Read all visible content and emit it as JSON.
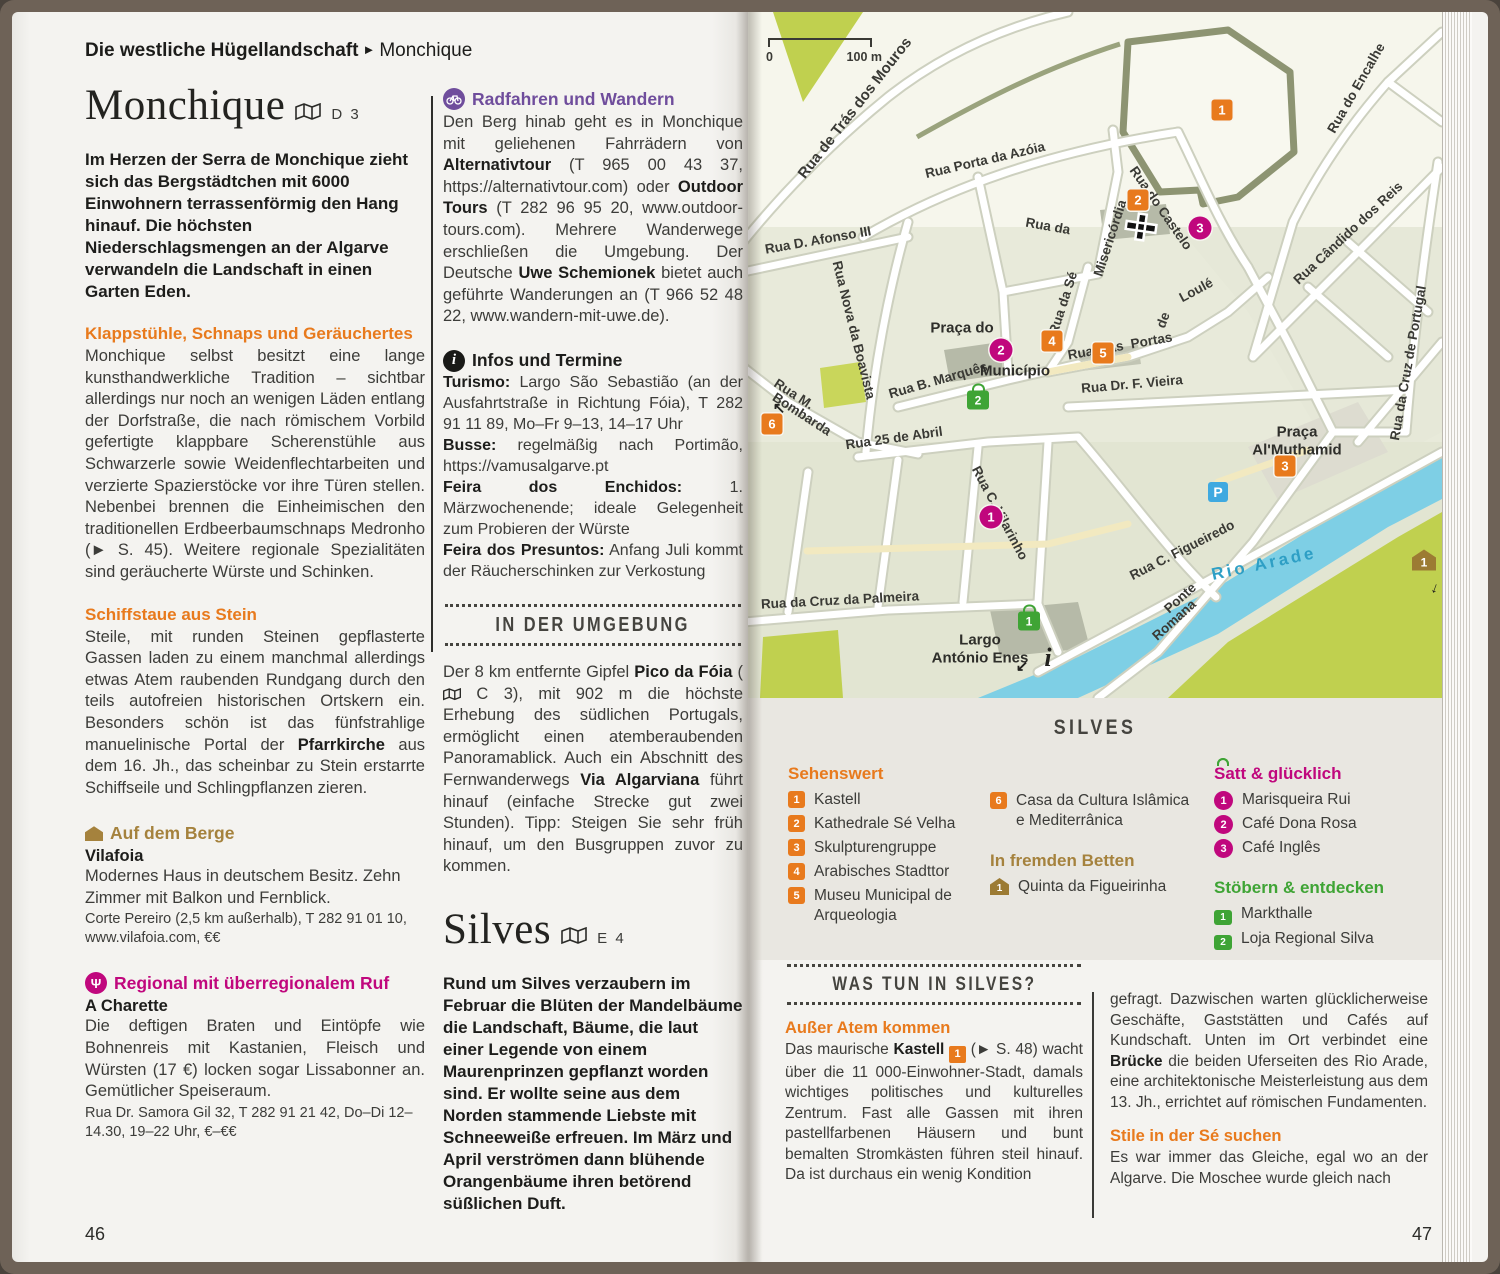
{
  "running_head": {
    "section": "Die westliche Hügellandschaft",
    "arrow": "►",
    "topic": "Monchique"
  },
  "page_numbers": {
    "left": "46",
    "right": "47"
  },
  "monchique": {
    "title": "Monchique",
    "map_ref": "D 3",
    "lead": "Im Herzen der Serra de Monchique zieht sich das Bergstädtchen mit 6000 Einwohnern terrassenförmig den Hang hinauf. Die höchsten Niederschlagsmengen an der Algarve verwandeln die Landschaft in einen Garten Eden.",
    "s1_heading": "Klappstühle, Schnaps und Geräuchertes",
    "s1_body": "Monchique selbst besitzt eine lange kunsthandwerkliche Tradition – sichtbar allerdings nur noch an wenigen Läden entlang der Dorfstraße, die nach römischem Vorbild gefertigte klappbare Scherenstühle aus Schwarzerle sowie Weidenflechtarbeiten und verzierte Spazierstöcke vor ihre Türen stellen. Nebenbei brennen die Einheimischen den traditionellen Erdbeerbaumschnaps Medronho (► S. 45). Weitere regionale Spezialitäten sind geräucherte Würste und Schinken.",
    "s2_heading": "Schiffstaue aus Stein",
    "s2_a": "Steile, mit runden Steinen gepflasterte Gassen laden zu einem manchmal allerdings etwas Atem raubenden Rundgang durch den teils autofreien historischen Ortskern ein. Besonders schön ist das fünfstrahlige manuelinische Portal der ",
    "s2_b": "Pfarrkirche",
    "s2_c": " aus dem 16. Jh., das scheinbar zu Stein erstarrte Schiffseile und Schlingpflanzen zieren.",
    "hotel": {
      "heading": "Auf dem Berge",
      "name": "Vilafoia",
      "body": "Modernes Haus in deutschem Besitz. Zehn Zimmer mit Balkon und Fernblick.",
      "details": "Corte Pereiro (2,5 km außerhalb), T 282 91 01 10, www.vilafoia.com, €€"
    },
    "restaurant": {
      "heading": "Regional mit überregionalem Ruf",
      "name": "A Charette",
      "body": "Die deftigen Braten und Eintöpfe wie Bohnenreis mit Kastanien, Fleisch und Würsten (17 €) locken sogar Lissabonner an. Gemütlicher Speiseraum.",
      "details": "Rua Dr. Samora Gil 32, T 282 91 21 42, Do–Di 12–14.30, 19–22 Uhr, €–€€"
    }
  },
  "activities": {
    "heading": "Radfahren und Wandern",
    "p1": "Den Berg hinab geht es in Monchique mit geliehenen Fahrrädern von ",
    "b1": "Alternativtour",
    "p2": " (T 965 00 43 37, https://alternativtour.com) oder ",
    "b2": "Outdoor Tours",
    "p3": " (T 282 96 95 20, www.outdoor-tours.com). Mehrere Wanderwege erschließen die Umgebung. Der Deutsche ",
    "b3": "Uwe Schemionek",
    "p4": " bietet auch geführte Wanderungen an (T 966 52 48 22, www.wandern-mit-uwe.de)."
  },
  "infos": {
    "heading": "Infos und Termine",
    "i1_label": "Turismo:",
    "i1_text": " Largo São Sebastião (an der Ausfahrtstraße in Richtung Fóia), T 282 91 11 89, Mo–Fr 9–13, 14–17 Uhr",
    "i2_label": "Busse:",
    "i2_text": " regelmäßig nach Portimão, https://vamusalgarve.pt",
    "i3_label": "Feira dos Enchidos:",
    "i3_text": " 1. Märzwochenende; ideale Gelegenheit zum Probieren der Würste",
    "i4_label": "Feira dos Presuntos:",
    "i4_text": " Anfang Juli kommt der Räucherschinken zur Verkostung"
  },
  "umgebung": {
    "banner": "IN DER UMGEBUNG",
    "p1": "Der 8 km entfernte Gipfel ",
    "b1": "Pico da Fóia",
    "p2": " (",
    "p2b": " C 3), mit 902 m die höchste Erhebung des südlichen Portugals, ermöglicht einen atemberaubenden Panoramablick. Auch ein Abschnitt des Fernwanderwegs ",
    "b2": "Via Algarviana",
    "p3": " führt hinauf (einfache Strecke gut zwei Stunden). Tipp: Steigen Sie sehr früh hinauf, um den Busgruppen zuvor zu kommen."
  },
  "silves": {
    "title": "Silves",
    "map_ref": "E 4",
    "lead": "Rund um Silves verzaubern im Februar die Blüten der Mandelbäume die Landschaft, Bäume, die laut einer Legende von einem Maurenprinzen gepflanzt worden sind. Er wollte seine aus dem Norden stammende Liebste mit Schneeweiße erfreuen. Im März und April verströmen dann blühende Orangenbäume ihren betörend süßlichen Duft."
  },
  "map": {
    "scale0": "0",
    "scale100": "100 m",
    "labels": [
      {
        "t": "Rua de Trás dos Mouros"
      },
      {
        "t": "Rua Porta da Azóia"
      },
      {
        "t": "Rua D. Afonso III"
      },
      {
        "t": "Rua Nova da Boavista"
      },
      {
        "t": "Rua da"
      },
      {
        "t": "Misericórdia"
      },
      {
        "t": "Rua do Castelo"
      },
      {
        "t": "Rua do Encalhe"
      },
      {
        "t": "Rua Cândido dos Reis"
      },
      {
        "t": "Rua da Cruz de Portugal"
      },
      {
        "t": "Rua da Sé"
      },
      {
        "t": "Rua  das  Portas"
      },
      {
        "t": "de"
      },
      {
        "t": "Loulé"
      },
      {
        "t": "Rua Dr. F. Vieira"
      },
      {
        "t": "Rua B. Marquês"
      },
      {
        "t": "Rua M."
      },
      {
        "t": "Bombarda"
      },
      {
        "t": "Rua 25 de Abril"
      },
      {
        "t": "Rua C. Vilarinho"
      },
      {
        "t": "Rua da Cruz da Palmeira"
      },
      {
        "t": "Rua C. Figueiredo"
      },
      {
        "t": "Ponte"
      },
      {
        "t": "Romana"
      },
      {
        "t": "Rio Arade"
      },
      {
        "t": "Praça do"
      },
      {
        "t": "Município"
      },
      {
        "t": "Praça"
      },
      {
        "t": "Al'Muthamid"
      },
      {
        "t": "Largo"
      },
      {
        "t": "António Enes"
      }
    ],
    "sights": [
      {
        "n": "1"
      },
      {
        "n": "2"
      },
      {
        "n": "3"
      },
      {
        "n": "4"
      },
      {
        "n": "5"
      },
      {
        "n": "6"
      }
    ],
    "food": [
      {
        "n": "1"
      },
      {
        "n": "2"
      },
      {
        "n": "3"
      }
    ],
    "shop": [
      {
        "n": "1"
      },
      {
        "n": "2"
      }
    ],
    "bed": [
      {
        "n": "1"
      }
    ],
    "parking": "P",
    "info": "i",
    "icons": {
      "arrow_nw": "↖",
      "arrow_sw": "↙",
      "arrow_down": "↓"
    }
  },
  "legend": {
    "title": "SILVES",
    "sights_heading": "Sehenswert",
    "s1": "Kastell",
    "s2": "Kathedrale Sé Velha",
    "s3": "Skulpturengruppe",
    "s4": "Arabisches Stadttor",
    "s5": "Museu Municipal de Arqueologia",
    "s6": "Casa da Cultura Islâmica e Mediterrânica",
    "beds_heading": "In fremden Betten",
    "bed1": "Quinta da Figueirinha",
    "food_heading": "Satt & glücklich",
    "f1": "Marisqueira Rui",
    "f2": "Café Dona Rosa",
    "f3": "Café Inglês",
    "shop_heading": "Stöbern & entdecken",
    "sh1": "Markthalle",
    "sh2": "Loja Regional Silva"
  },
  "was_tun": {
    "banner": "WAS TUN IN SILVES?",
    "h1": "Außer Atem kommen",
    "p1a": "Das maurische ",
    "p1b": "Kastell",
    "p1marker": "1",
    "p1c": " (► S. 48) wacht über die 11 000-Einwohner-Stadt, damals wichtiges politisches und kulturelles Zentrum. Fast alle Gassen mit ihren pastellfarbenen Häusern und bunt bemalten Stromkästen führen steil hinauf. Da ist durchaus ein wenig Kondition",
    "p2a": "gefragt. Dazwischen warten glücklicherweise Geschäfte, Gaststätten und Cafés auf Kundschaft. Unten im Ort verbindet eine ",
    "p2b": "Brücke",
    "p2c": " die beiden Uferseiten des Rio Arade, eine architektonische Meisterleistung aus dem 13. Jh., errichtet auf römischen Fundamenten.",
    "h2": "Stile in der Sé suchen",
    "p3": "Es war immer das Gleiche, egal wo an der Algarve. Die Moschee wurde gleich nach"
  }
}
